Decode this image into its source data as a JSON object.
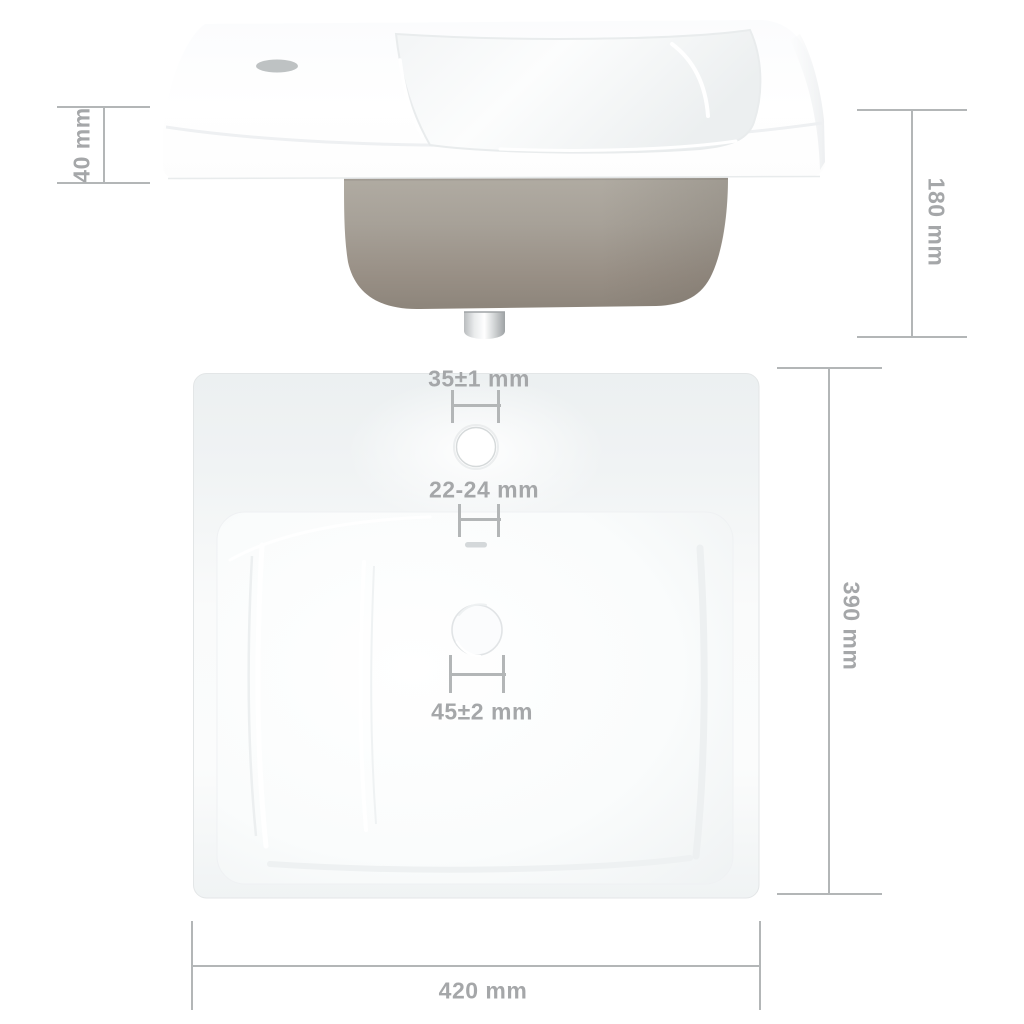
{
  "labels": {
    "rim_height": "40 mm",
    "total_height": "180 mm",
    "faucet_hole": "35±1 mm",
    "overflow_hole": "22-24 mm",
    "drain_hole": "45±2 mm",
    "depth": "390 mm",
    "width": "420 mm"
  },
  "colors": {
    "background": "#ffffff",
    "dimension_line": "#b3b6b7",
    "dimension_text": "#a5a7a9",
    "ceramic_shadow": "#eef0f1",
    "bowl_gray": "#a09a90",
    "chrome": "#d9dcdd"
  }
}
